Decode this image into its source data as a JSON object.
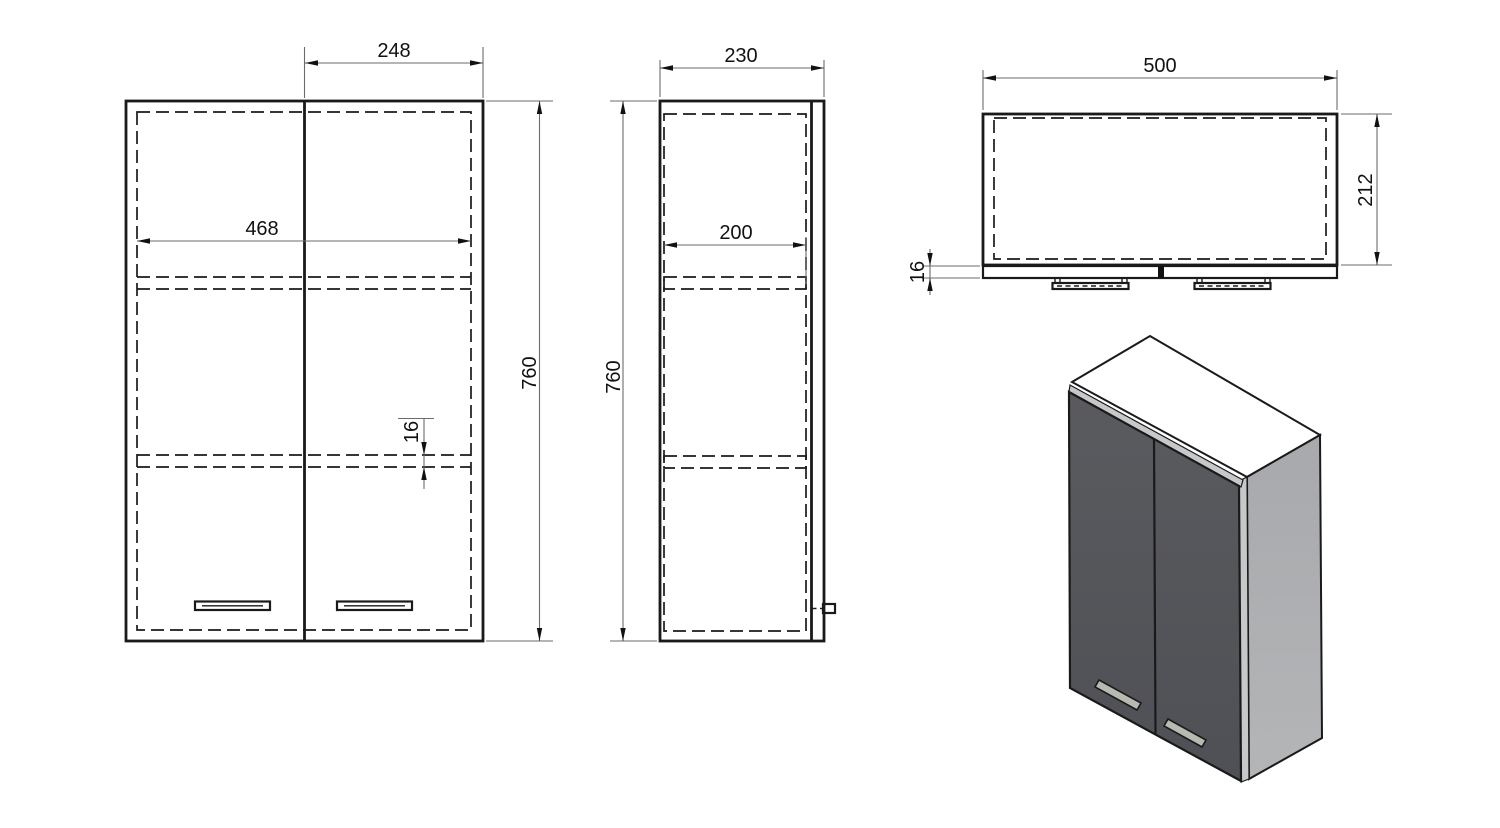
{
  "views": {
    "front": {
      "door_width_mm": "248",
      "opening_width_mm": "468",
      "height_mm": "760",
      "shelf_thickness_mm": "16"
    },
    "side": {
      "depth_mm": "230",
      "shelf_depth_mm": "200",
      "height_mm": "760"
    },
    "top": {
      "width_mm": "500",
      "carcass_depth_mm": "212",
      "door_thickness_mm": "16"
    }
  },
  "iso": {
    "colors": {
      "top_face": "#d3d4d6",
      "right_face_top": "#a8a9ac",
      "right_face_bottom": "#b4b5b7",
      "front_doors_top": "#5a5b5f",
      "front_doors_bottom": "#4f5055",
      "edge_strip": "#c7c8c9",
      "handle_fill": "#b7bab0",
      "outline": "#1a1a1a"
    }
  }
}
